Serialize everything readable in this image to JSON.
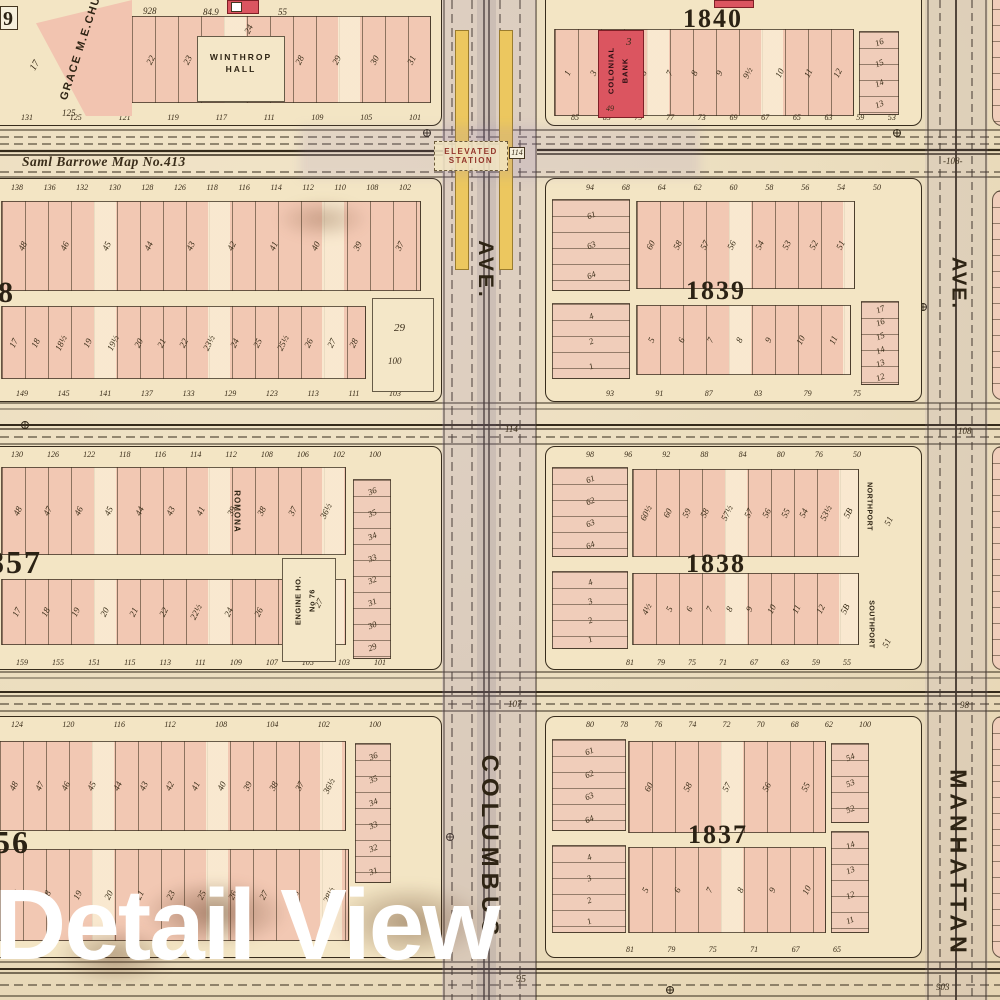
{
  "watermark": "Detail View",
  "street_title": "Saml Barrowe Map No.413",
  "station": {
    "line1": "ELEVATED",
    "line2": "STATION",
    "number": "114"
  },
  "avenues": {
    "columbus_name": "COLUMBUS",
    "columbus_ave": "AVE.",
    "manhattan_name": "MANHATTAN",
    "manhattan_ave": "AVE.",
    "manhattan_house": "-108-"
  },
  "corners": {
    "c114_mid": "114",
    "c107": "107",
    "c108_right": "108",
    "c98": "98",
    "c95": "95",
    "c903": "903"
  },
  "top_edge": {
    "n1": "928",
    "n2": "84.9",
    "n3": "55"
  },
  "block_numbers": {
    "b1840": "1840",
    "b1839": "1839",
    "b1838": "1838",
    "b1837": "1837",
    "b1857": "857",
    "b1856": "56",
    "b1858": "8",
    "b1859": "9"
  },
  "buildings": {
    "church": "GRACE M.E.CHURCH",
    "church_lot": "17",
    "church_front": "125",
    "winthrop1": "WINTHROP",
    "winthrop2": "HALL",
    "winthrop_lot": "24",
    "colonial1": "COLONIAL",
    "colonial2": "BANK",
    "colonial_lot": "3",
    "colonial_front": "49",
    "romona": "ROMONA",
    "engine1": "ENGINE HO.",
    "engine2": "No 76",
    "engine_lot": "27",
    "northport": "NORTHPORT",
    "northport_lot": "51",
    "southport": "SOUTHPORT",
    "southport_lot": "51"
  },
  "blocks": {
    "L1": {
      "upper_lots": [
        "22",
        "23",
        "24",
        "27",
        "28",
        "29",
        "30",
        "31"
      ],
      "addresses": [
        "131",
        "125",
        "121",
        "119",
        "117",
        "111",
        "109",
        "105",
        "101"
      ]
    },
    "R1": {
      "upper_lots": [
        "1",
        "3",
        "5",
        "6",
        "7",
        "8",
        "9",
        "9½",
        "10",
        "11",
        "12"
      ],
      "right_col": [
        "16",
        "15",
        "14",
        "13"
      ],
      "addresses": [
        "85",
        "83",
        "79",
        "77",
        "73",
        "69",
        "67",
        "65",
        "63",
        "59",
        "53"
      ]
    },
    "L2": {
      "frontages": [
        "138",
        "136",
        "132",
        "130",
        "128",
        "126",
        "118",
        "116",
        "114",
        "112",
        "110",
        "108",
        "102"
      ],
      "upper_lots": [
        "48",
        "46",
        "45",
        "44",
        "43",
        "42",
        "41",
        "40",
        "39",
        "37"
      ],
      "lower_lots": [
        "17",
        "18",
        "18½",
        "19",
        "19½",
        "20",
        "21",
        "22",
        "23½",
        "24",
        "25",
        "25½",
        "26",
        "27",
        "28"
      ],
      "big_lot": "29",
      "big_lot_front": "100",
      "addresses": [
        "149",
        "145",
        "141",
        "137",
        "133",
        "129",
        "123",
        "113",
        "111",
        "103"
      ]
    },
    "R2": {
      "frontages": [
        "94",
        "68",
        "64",
        "62",
        "60",
        "58",
        "56",
        "54",
        "50"
      ],
      "left_col": [
        "61",
        "63",
        "64"
      ],
      "upper_lots": [
        "60",
        "58",
        "57",
        "56",
        "54",
        "53",
        "52",
        "51"
      ],
      "lower_left_col": [
        "4",
        "2",
        "1"
      ],
      "lower_lots": [
        "5",
        "6",
        "7",
        "8",
        "9",
        "10",
        "11"
      ],
      "right_col": [
        "17",
        "16",
        "15",
        "14",
        "13",
        "12"
      ],
      "addresses": [
        "93",
        "91",
        "87",
        "83",
        "79",
        "75"
      ]
    },
    "L3": {
      "frontages": [
        "130",
        "126",
        "122",
        "118",
        "116",
        "114",
        "112",
        "108",
        "106",
        "102",
        "100"
      ],
      "upper_lots": [
        "48",
        "47",
        "46",
        "45",
        "44",
        "43",
        "41",
        "39",
        "38",
        "37",
        "36½"
      ],
      "right_col": [
        "36",
        "35",
        "34",
        "33",
        "32",
        "31",
        "30",
        "29"
      ],
      "lower_lots": [
        "17",
        "18",
        "19",
        "20",
        "21",
        "22",
        "22½",
        "24",
        "26",
        "26½",
        "28½"
      ],
      "addresses": [
        "159",
        "155",
        "151",
        "115",
        "113",
        "111",
        "109",
        "107",
        "105",
        "103",
        "101"
      ]
    },
    "R3": {
      "frontages": [
        "98",
        "96",
        "92",
        "88",
        "84",
        "80",
        "76",
        "50"
      ],
      "left_col": [
        "61",
        "62",
        "63",
        "64"
      ],
      "upper_lots": [
        "60½",
        "60",
        "59",
        "58",
        "57½",
        "57",
        "56",
        "55",
        "54",
        "53½",
        "5B"
      ],
      "lower_left_col": [
        "4",
        "3",
        "2",
        "1"
      ],
      "lower_lots": [
        "4½",
        "5",
        "6",
        "7",
        "8",
        "9",
        "10",
        "11",
        "12",
        "5B"
      ],
      "addresses": [
        "81",
        "79",
        "75",
        "71",
        "67",
        "63",
        "59",
        "55"
      ]
    },
    "L4": {
      "frontages": [
        "124",
        "120",
        "116",
        "112",
        "108",
        "104",
        "102",
        "100"
      ],
      "upper_lots": [
        "48",
        "47",
        "46",
        "45",
        "44",
        "43",
        "42",
        "41",
        "40",
        "39",
        "38",
        "37",
        "36½"
      ],
      "right_col": [
        "36",
        "35",
        "34",
        "33",
        "32",
        "31"
      ],
      "lower_lots": [
        "17",
        "18",
        "19",
        "20",
        "21",
        "23",
        "25",
        "26",
        "27",
        "28",
        "28½"
      ]
    },
    "R4": {
      "frontages": [
        "80",
        "78",
        "76",
        "74",
        "72",
        "70",
        "68",
        "62",
        "100"
      ],
      "left_col": [
        "61",
        "62",
        "63",
        "64"
      ],
      "upper_lots": [
        "60",
        "58",
        "57",
        "56",
        "55"
      ],
      "upper_right_col": [
        "54",
        "53",
        "52"
      ],
      "lower_left_col": [
        "4",
        "3",
        "2",
        "1"
      ],
      "lower_lots": [
        "5",
        "6",
        "7",
        "8",
        "9",
        "10"
      ],
      "right_col": [
        "14",
        "13",
        "12",
        "11"
      ],
      "addresses": [
        "81",
        "79",
        "75",
        "71",
        "67",
        "65"
      ]
    }
  }
}
